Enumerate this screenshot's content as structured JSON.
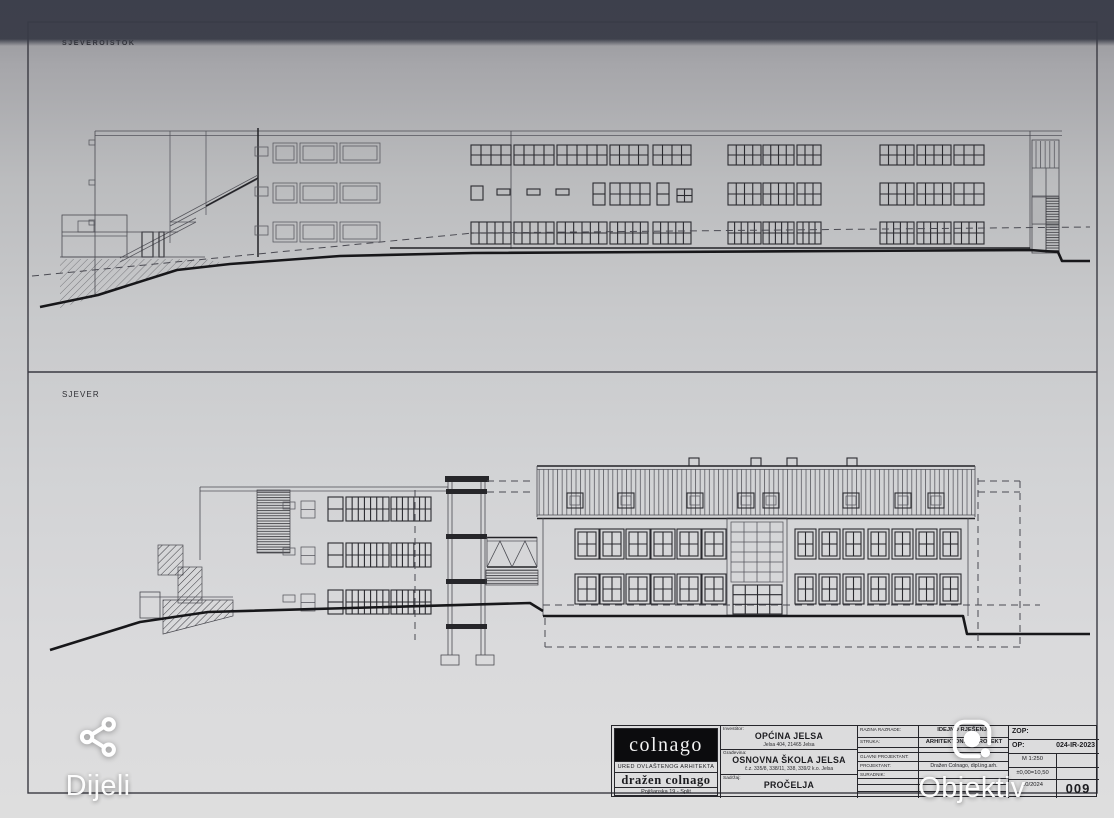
{
  "viewer": {
    "share_label": "Dijeli",
    "lens_label": "Objektiv"
  },
  "sheet": {
    "panel_top_label": "SJEVEROISTOK",
    "panel_bottom_label": "SJEVER",
    "titleblock": {
      "firm": {
        "logo_text": "colnago",
        "office_line": "URED OVLAŠTENOG ARHITEKTA",
        "architect_name": "dražen colnago",
        "address_line": "Pojišanska 19 - Split"
      },
      "client": {
        "label": "Investitor:",
        "name": "OPĆINA JELSA",
        "address": "Jelsa 404, 21465 Jelsa"
      },
      "project": {
        "label": "Građevina:",
        "name": "OSNOVNA ŠKOLA JELSA",
        "parcel": "č.z. 335/8, 338/11, 338, 339/2 k.o. Jelsa"
      },
      "content": {
        "label": "Sadržaj:",
        "name": "PROČELJA"
      },
      "meta": {
        "level_label": "RAZINA RAZRADE:",
        "level_value": "IDEJNO RJEŠENJE",
        "discipline_label": "STRUKA:",
        "discipline_value": "ARHITEKTONSKI PROJEKT",
        "chief_label": "GLAVNI PROJEKTANT:",
        "designer_label": "PROJEKTANT:",
        "designer_value": "Dražen Colnago, dipl.ing.arh.",
        "collaborator_label": "SURADNIK:"
      },
      "ids": {
        "zop_label": "ZOP:",
        "op_label": "OP:",
        "op_value": "024-IR-2023",
        "scale": "M 1:250",
        "datum": "±0,00=10,50",
        "date": "10/2024",
        "sheet_no": "009"
      }
    }
  }
}
